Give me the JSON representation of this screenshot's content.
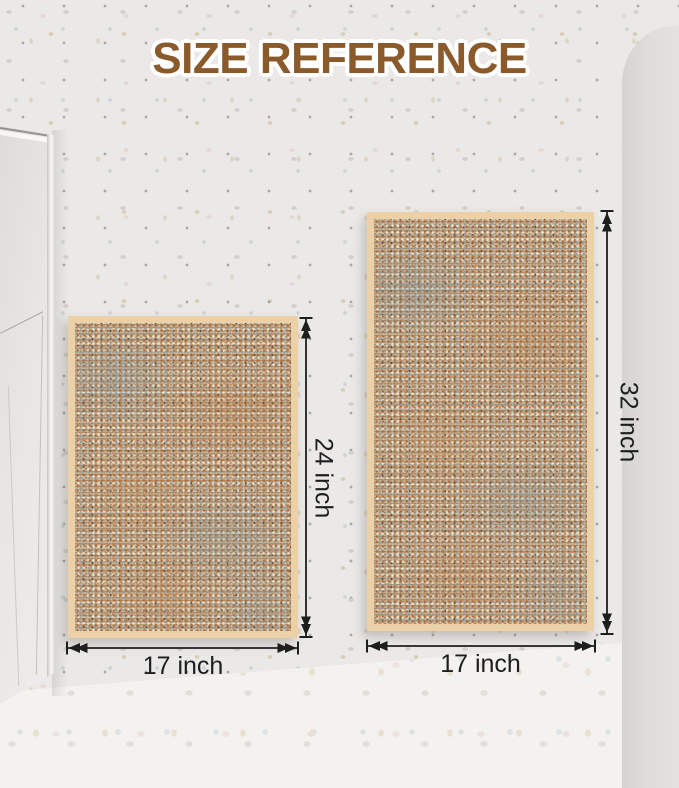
{
  "title": "SIZE REFERENCE",
  "theme": {
    "title_color": "#8a5a2b",
    "wall_color": "#eae9e7",
    "floor_color": "#f3f2ef",
    "right_wall_color": "#dedddb",
    "cabinet_color": "#e9e7e4",
    "rug_border_color": "#ecd0a7",
    "rug_texture_base_color": "#b9a183",
    "dimension_color": "#1e1e1e"
  },
  "rugs": [
    {
      "name": "small rug",
      "width_label": "17 inch",
      "height_label": "24 inch"
    },
    {
      "name": "large rug",
      "width_label": "17 inch",
      "height_label": "32 inch"
    }
  ]
}
